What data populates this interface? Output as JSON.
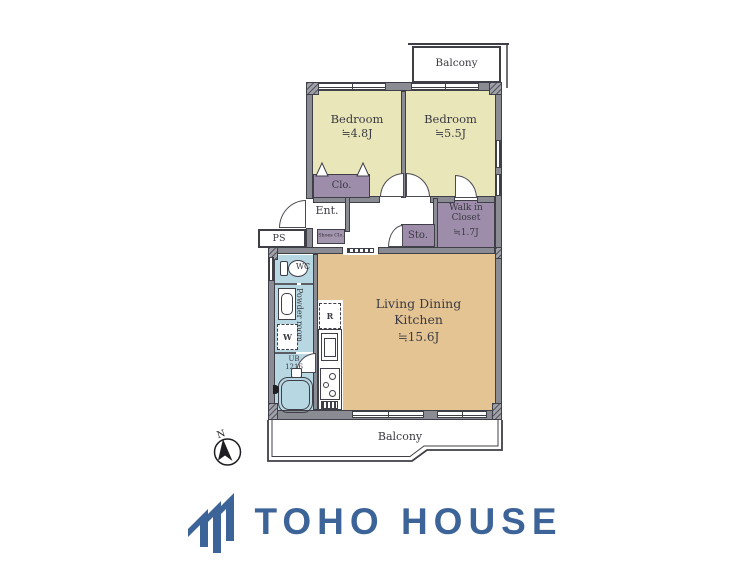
{
  "floorplan": {
    "balcony_top": "Balcony",
    "balcony_bottom": "Balcony",
    "bedroom1": {
      "name": "Bedroom",
      "area": "≒4.8J"
    },
    "bedroom2": {
      "name": "Bedroom",
      "area": "≒5.5J"
    },
    "ldk": {
      "name_line1": "Living Dining",
      "name_line2": "Kitchen",
      "area": "≒15.6J"
    },
    "walk_in_closet": {
      "name_line1": "Walk in",
      "name_line2": "Closet",
      "area": "≒1.7J"
    },
    "closet": "Clo.",
    "entrance": "Ent.",
    "shoes_closet": "Shoes Clo.",
    "storage": "Sto.",
    "pipe_space": "PS",
    "wc": "WC",
    "powder_room": "Powder room",
    "unit_bath": {
      "line1": "UB",
      "line2": "1216"
    },
    "washer": "W",
    "refrigerator": "R",
    "compass_north": "N",
    "colors": {
      "bedroom_floor": "#e9e6b9",
      "ldk_floor": "#e5c493",
      "wet_area": "#b7d7e2",
      "closet_fill": "#9e8cab",
      "wall": "#8b8b93",
      "outline": "#3f3f48"
    }
  },
  "footer": {
    "brand": "TOHO HOUSE",
    "brand_color": "#3d6498"
  }
}
